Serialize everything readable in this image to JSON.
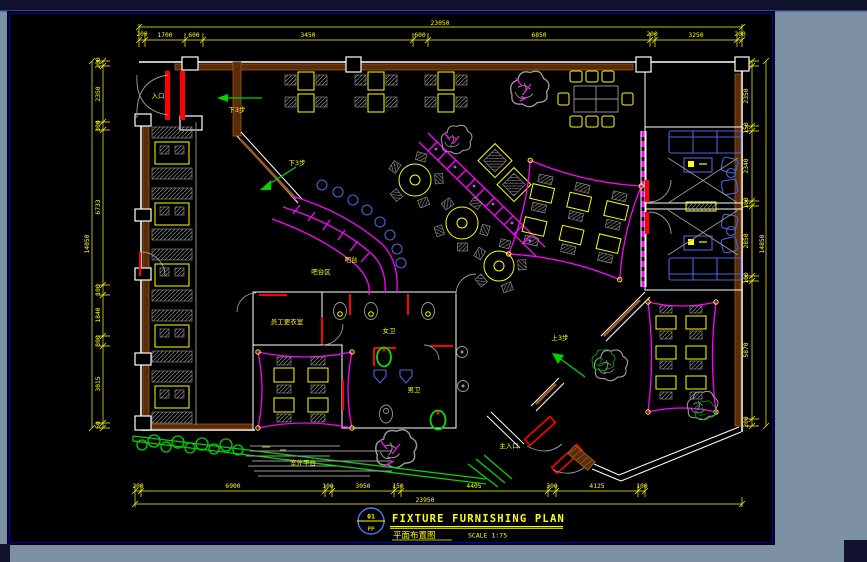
{
  "window": {
    "frame_bg": "#7d90a4",
    "top_strip": "#10122e",
    "canvas_bg": "#000000",
    "border_blue": "#0000b2"
  },
  "title_block": {
    "sheet_circle_top": "01",
    "sheet_circle_bottom": "PP",
    "title_en": "FIXTURE  FURNISHING  PLAN",
    "title_cn": "平面布置图",
    "scale_label": "SCALE 1:75"
  },
  "plan_labels": {
    "entrance": "入口",
    "main_entrance": "主入口",
    "down_steps_a": "下3步",
    "down_steps_b": "下3步",
    "up_steps": "上3步",
    "bar": "吧台",
    "bar_area": "吧台区",
    "staff_room": "员工更衣室",
    "female_wc": "女卫",
    "male_wc": "男卫",
    "outdoor_deck": "室外平台"
  },
  "dimensions": {
    "top": {
      "total": "23050",
      "segments": [
        "200",
        "1700",
        "600",
        "3450",
        "600",
        "6850",
        "200",
        "3250",
        "200"
      ]
    },
    "bottom": {
      "total": "23950",
      "segments": [
        "200",
        "6900",
        "100",
        "3050",
        "150",
        "4405",
        "300",
        "4125",
        "100"
      ]
    },
    "left": {
      "total": "14050",
      "segments": [
        "200",
        "2350",
        "300",
        "6733",
        "100",
        "1840",
        "300",
        "3015",
        "50"
      ]
    },
    "right": {
      "total": "14850",
      "segments": [
        "200",
        "2350",
        "150",
        "2340",
        "100",
        "2850",
        "100",
        "5870",
        "200"
      ]
    }
  },
  "colors": {
    "dimension_yellow": "#ffff00",
    "wall_white": "#ffffff",
    "wood_brown": "#8b4513",
    "door_red": "#ff0000",
    "counter_magenta": "#ff00ff",
    "fixture_blue": "#4a63d8",
    "plant_green": "#00d200",
    "tree_gray": "#9a9a9a"
  }
}
